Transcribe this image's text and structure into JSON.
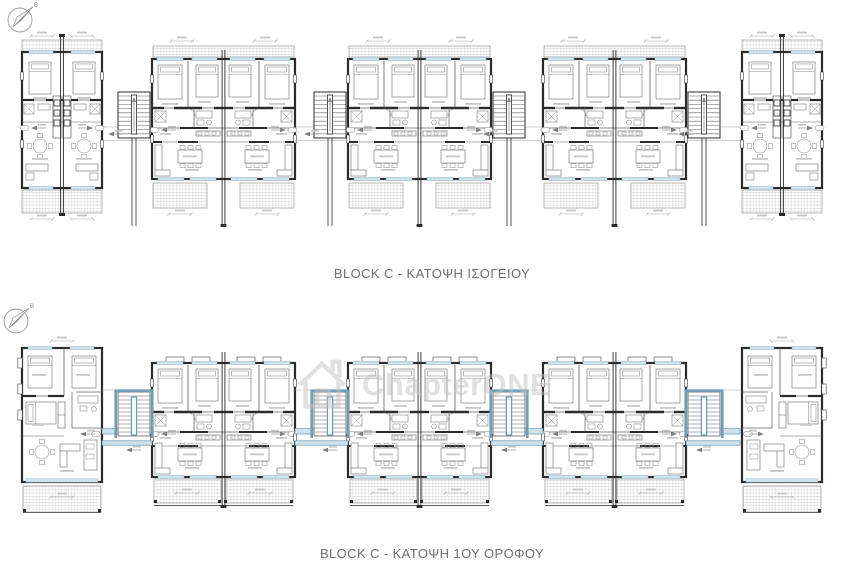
{
  "drawing": {
    "rows": [
      {
        "id": "ground-floor",
        "title": "BLOCK C - ΚΑΤΟΨΗ ΙΣΟΓΕΙΟΥ"
      },
      {
        "id": "first-floor",
        "title": "BLOCK C - ΚΑΤΟΨΗ 1ΟΥ ΟΡΟΦΟΥ"
      }
    ],
    "compass_label": "Β",
    "watermark": {
      "text": "ChapterONE"
    },
    "colors": {
      "wall": "#2b2b2b",
      "partition": "#606060",
      "furniture": "#8f8f8f",
      "label_smudge": "#c6c6c6",
      "hatch_line": "#c2c2c2",
      "hatch_border": "#9a9a9a",
      "window_blue": "#cfe3ec",
      "window_blue_border": "#97bcce",
      "walkway_blue": "#cfe2ec",
      "walkway_blue_border": "#679ab3",
      "stair_blue": "#6f9fb8",
      "dim_gray": "#ababab",
      "title_text": "#6f6f6f",
      "watermark_gray": "#c2c2c2"
    }
  }
}
